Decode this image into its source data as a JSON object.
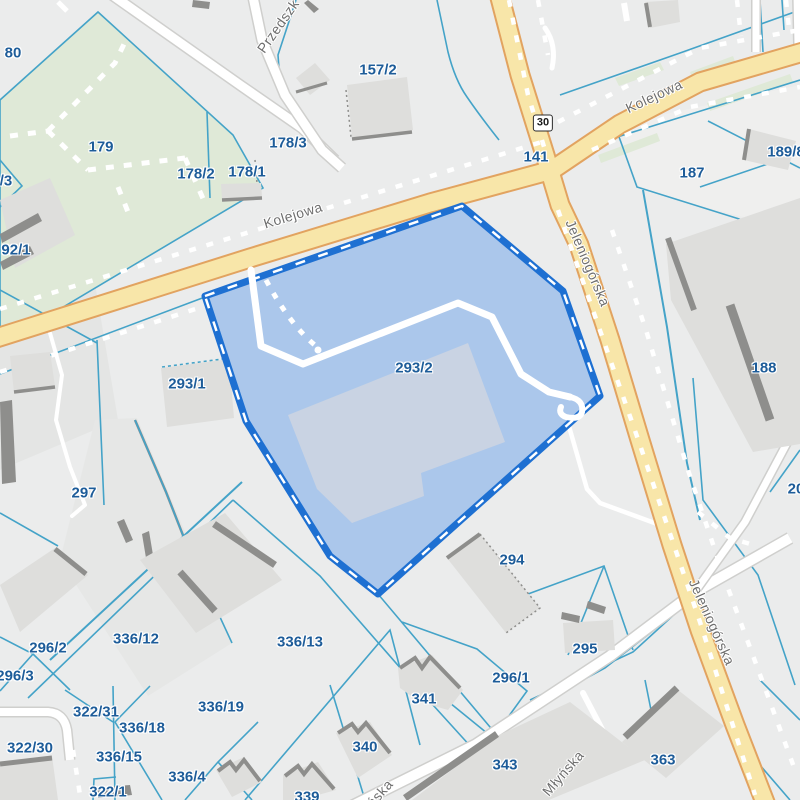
{
  "map": {
    "title": "Cadastral map view",
    "highlighted_parcel_id": "293/2",
    "road_badge": {
      "text": "30",
      "x": 543,
      "y": 123
    },
    "colors": {
      "background": "#EBECEC",
      "parcel_boundary": "#44A3C8",
      "parcel_label": "#1D5C99",
      "street_label": "#6E6E6E",
      "road_fill": "#F8E6A9",
      "road_casing": "#E2A360",
      "park_green": "#DFE9D7",
      "building": "#DEDEDC",
      "building_shadow": "#8E8E8C",
      "selection_fill": "#ABC7EB",
      "selection_stroke": "#1E70D2"
    },
    "parcel_labels": [
      {
        "text": "80",
        "x": 13,
        "y": 53
      },
      {
        "text": "179",
        "x": 101,
        "y": 147
      },
      {
        "text": "178/2",
        "x": 196,
        "y": 174
      },
      {
        "text": "178/1",
        "x": 247,
        "y": 172
      },
      {
        "text": "178/3",
        "x": 288,
        "y": 143
      },
      {
        "text": "157/2",
        "x": 378,
        "y": 70
      },
      {
        "text": "141",
        "x": 536,
        "y": 157
      },
      {
        "text": "187",
        "x": 692,
        "y": 173
      },
      {
        "text": "189/8",
        "x": 786,
        "y": 152
      },
      {
        "text": "/3",
        "x": 6,
        "y": 181
      },
      {
        "text": "92/1",
        "x": 16,
        "y": 250
      },
      {
        "text": "293/1",
        "x": 187,
        "y": 384
      },
      {
        "text": "293/2",
        "x": 414,
        "y": 368
      },
      {
        "text": "188",
        "x": 764,
        "y": 368
      },
      {
        "text": "297",
        "x": 84,
        "y": 493
      },
      {
        "text": "294",
        "x": 512,
        "y": 560
      },
      {
        "text": "295",
        "x": 585,
        "y": 649
      },
      {
        "text": "296/1",
        "x": 511,
        "y": 678
      },
      {
        "text": "296/2",
        "x": 48,
        "y": 648
      },
      {
        "text": "296/3",
        "x": 15,
        "y": 676
      },
      {
        "text": "336/12",
        "x": 136,
        "y": 639
      },
      {
        "text": "336/13",
        "x": 300,
        "y": 642
      },
      {
        "text": "336/19",
        "x": 221,
        "y": 707
      },
      {
        "text": "322/31",
        "x": 96,
        "y": 712
      },
      {
        "text": "336/18",
        "x": 142,
        "y": 728
      },
      {
        "text": "322/30",
        "x": 30,
        "y": 748
      },
      {
        "text": "336/15",
        "x": 119,
        "y": 757
      },
      {
        "text": "322/1",
        "x": 108,
        "y": 792
      },
      {
        "text": "336/4",
        "x": 187,
        "y": 777
      },
      {
        "text": "341",
        "x": 424,
        "y": 699
      },
      {
        "text": "340",
        "x": 365,
        "y": 747
      },
      {
        "text": "339",
        "x": 307,
        "y": 797
      },
      {
        "text": "343",
        "x": 505,
        "y": 765
      },
      {
        "text": "363",
        "x": 663,
        "y": 760
      },
      {
        "text": "20",
        "x": 796,
        "y": 489
      }
    ],
    "street_labels": [
      {
        "text": "Przedszk",
        "x": 278,
        "y": 26,
        "rot": -55
      },
      {
        "text": "Kolejowa",
        "x": 293,
        "y": 215,
        "rot": -17
      },
      {
        "text": "Kolejowa",
        "x": 654,
        "y": 96,
        "rot": -25
      },
      {
        "text": "Jeleniogórska",
        "x": 588,
        "y": 263,
        "rot": 67
      },
      {
        "text": "Jeleniogórska",
        "x": 712,
        "y": 622,
        "rot": 66
      },
      {
        "text": "Młyńska",
        "x": 563,
        "y": 773,
        "rot": -49
      },
      {
        "text": "Młyńska",
        "x": 372,
        "y": 802,
        "rot": -49
      }
    ]
  }
}
